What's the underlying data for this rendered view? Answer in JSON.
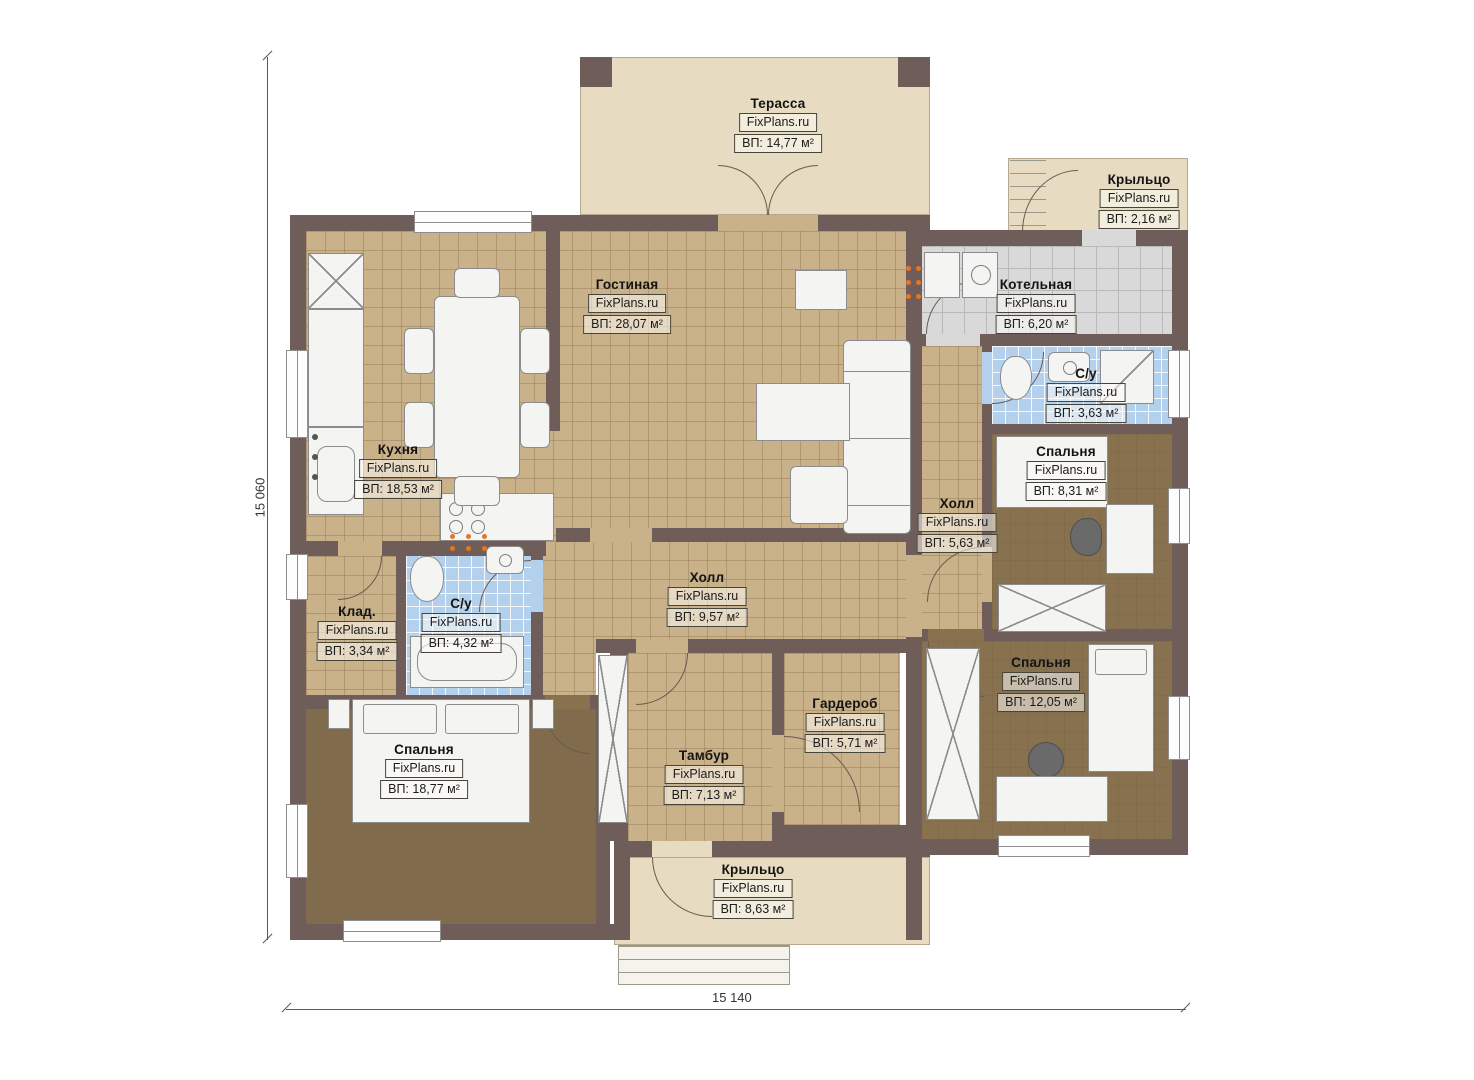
{
  "plan": {
    "watermark": "FixPlans.ru",
    "dimensions": {
      "height_mm": "15 060",
      "width_mm": "15 140"
    },
    "rooms": [
      {
        "name": "Терасса",
        "area": "ВП: 14,77 м²"
      },
      {
        "name": "Крыльцо",
        "area": "ВП: 2,16 м²"
      },
      {
        "name": "Котельная",
        "area": "ВП: 6,20 м²"
      },
      {
        "name": "С/у",
        "area": "ВП: 3,63 м²"
      },
      {
        "name": "Спальня",
        "area": "ВП: 8,31 м²"
      },
      {
        "name": "Гостиная",
        "area": "ВП: 28,07 м²"
      },
      {
        "name": "Кухня",
        "area": "ВП: 18,53 м²"
      },
      {
        "name": "Холл",
        "area": "ВП: 5,63 м²"
      },
      {
        "name": "Холл",
        "area": "ВП: 9,57 м²"
      },
      {
        "name": "Клад.",
        "area": "ВП: 3,34 м²"
      },
      {
        "name": "С/у",
        "area": "ВП: 4,32 м²"
      },
      {
        "name": "Спальня",
        "area": "ВП: 18,77 м²"
      },
      {
        "name": "Тамбур",
        "area": "ВП: 7,13 м²"
      },
      {
        "name": "Гардероб",
        "area": "ВП: 5,71 м²"
      },
      {
        "name": "Спальня",
        "area": "ВП: 12,05 м²"
      },
      {
        "name": "Крыльцо",
        "area": "ВП: 8,63 м²"
      }
    ],
    "colors": {
      "wall": "#6f5d5a",
      "tileTan": "#c9b189",
      "tileBlue": "#b3d0ec",
      "tileGray": "#d9d9d9",
      "floorBrown": "#816b4d",
      "floorBrown2": "#87714f",
      "beige": "#e7dcc2",
      "orange": "#e8761e",
      "furniture": "#f4f4f2",
      "line": "#6a5a50"
    }
  }
}
